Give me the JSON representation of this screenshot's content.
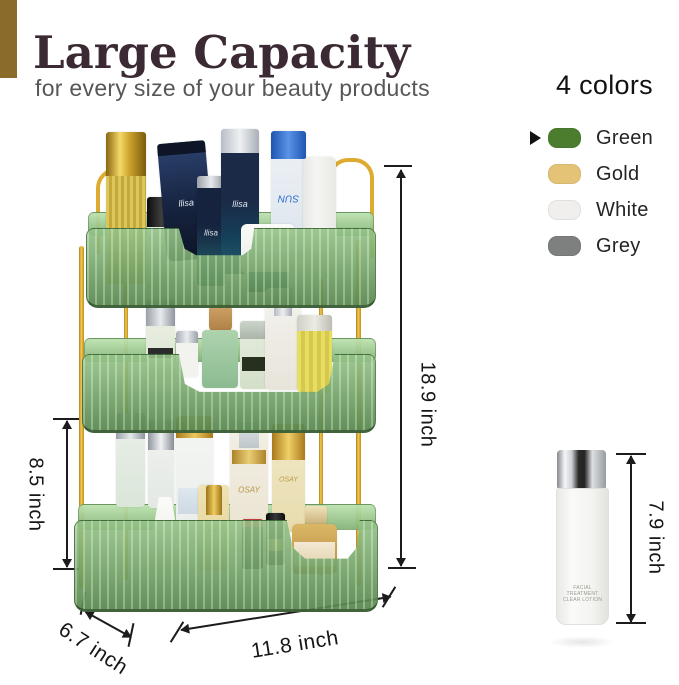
{
  "header": {
    "title": "Large Capacity",
    "subtitle": "for every size of your beauty products",
    "accent_bar_color": "#8a6b2b",
    "title_color": "#3b2a33"
  },
  "colors_panel": {
    "heading": "4 colors",
    "selected_index": 0,
    "items": [
      {
        "label": "Green",
        "swatch": "#4c7d2f"
      },
      {
        "label": "Gold",
        "swatch": "#e4c377"
      },
      {
        "label": "White",
        "swatch": "#f0efed"
      },
      {
        "label": "Grey",
        "swatch": "#7e8080"
      }
    ]
  },
  "dimensions": {
    "total_height": "18.9 inch",
    "tier_height": "8.5 inch",
    "bottle_height": "7.9 inch",
    "depth": "6.7 inch",
    "width": "11.8 inch"
  },
  "bottle": {
    "label_line1": "FACIAL TREATMENT",
    "label_line2": "CLEAR LOTION"
  },
  "organizer": {
    "frame_color": "#dcab2f",
    "tray_color": "#6fa263",
    "products": [
      {
        "name": "gold-cap-bottle",
        "l": 106,
        "t": 132,
        "w": 40,
        "h": 152,
        "r": "5px",
        "cap": {
          "h": 44,
          "c": "linear-gradient(90deg,#8a6510,#f3d967 35%,#caa02c 60%,#7c5a0e)"
        },
        "body": "repeating-linear-gradient(90deg,#dcc65c 0 3px,#c4a83a 3px 6px)"
      },
      {
        "name": "black-cap-bottle",
        "l": 147,
        "t": 197,
        "w": 29,
        "h": 92,
        "r": "4px",
        "cap": {
          "h": 30,
          "c": "linear-gradient(90deg,#0c0c0c,#3f3f3f,#111)"
        },
        "body": "linear-gradient(180deg,#e8efe9,#cfe0da)"
      },
      {
        "name": "navy-tube",
        "l": 162,
        "t": 142,
        "w": 48,
        "h": 118,
        "r": "8px",
        "rot": -5,
        "cap": {
          "h": 12,
          "c": "#0d1526"
        },
        "body": "linear-gradient(180deg,#2c4370,#16233f 55%,#0d1526)",
        "label": "llisa",
        "lc": "#e8ecf2",
        "fs": 9
      },
      {
        "name": "dark-serum-bottle",
        "l": 197,
        "t": 176,
        "w": 28,
        "h": 110,
        "r": "4px",
        "cap": {
          "h": 12,
          "c": "linear-gradient(90deg,#9aa0a8,#e6e9ec,#8f959d)"
        },
        "body": "linear-gradient(180deg,#16233f 45%,#1d4a5a 75%,#2e6b74)",
        "label": "llisa",
        "lc": "#dfe5ec",
        "fs": 8
      },
      {
        "name": "dark-pump-bottle",
        "l": 221,
        "t": 129,
        "w": 38,
        "h": 145,
        "r": "5px",
        "cap": {
          "h": 24,
          "c": "linear-gradient(90deg,#b9bec6,#eef0f3,#a9aeb6)"
        },
        "body": "linear-gradient(180deg,#1a2a47 50%,#15405a 75%,#27606e)",
        "label": "llisa",
        "lc": "#dfe5ec",
        "fs": 9
      },
      {
        "name": "sun-spray-can",
        "l": 271,
        "t": 131,
        "w": 35,
        "h": 128,
        "r": "6px",
        "cap": {
          "h": 28,
          "c": "linear-gradient(90deg,#1d55b0,#5b93e8,#1d55b0)"
        },
        "body": "linear-gradient(180deg,#eef2f6,#dbe4ec)",
        "label": "SUN",
        "lc": "#2f6fd0",
        "fs": 10,
        "flip": true
      },
      {
        "name": "white-mist-bottle",
        "l": 303,
        "t": 157,
        "w": 33,
        "h": 122,
        "r": "6px",
        "body": "linear-gradient(90deg,#e6e6e2,#f5f5f3 40%,#e8e8e4)"
      },
      {
        "name": "cream-jar",
        "l": 241,
        "t": 224,
        "w": 54,
        "h": 50,
        "r": "6px",
        "body": "linear-gradient(180deg,#fbfbf9,#e8e8e4)"
      },
      {
        "name": "jar-base",
        "l": 247,
        "t": 272,
        "w": 42,
        "h": 20,
        "r": "3px",
        "body": "linear-gradient(180deg,#2e6a78,#1d4c58)"
      },
      {
        "name": "cologne-bottle",
        "l": 146,
        "t": 300,
        "w": 29,
        "h": 78,
        "r": "3px",
        "cap": {
          "h": 26,
          "c": "linear-gradient(90deg,#9aa0a8,#e8ebee,#8f959d)"
        },
        "body": "linear-gradient(180deg,#edf0e6,#dce5d2)",
        "band": {
          "t": 48,
          "h": 10,
          "c": "#2b2b2b"
        }
      },
      {
        "name": "mini-bottle",
        "l": 176,
        "t": 331,
        "w": 22,
        "h": 46,
        "r": "3px",
        "cap": {
          "h": 12,
          "c": "linear-gradient(90deg,#a7adb5,#e9ecef,#9aa1a9)"
        },
        "body": "#f2f2ef"
      },
      {
        "name": "cork-cap",
        "l": 209,
        "t": 304,
        "w": 23,
        "h": 28,
        "r": "6px",
        "body": "linear-gradient(180deg,#cfa368,#b08044)"
      },
      {
        "name": "cork-bottle",
        "l": 202,
        "t": 330,
        "w": 36,
        "h": 58,
        "r": "4px",
        "body": "linear-gradient(180deg,#aed3ae,#8cbb90)"
      },
      {
        "name": "green-perfume",
        "l": 240,
        "t": 321,
        "w": 28,
        "h": 68,
        "r": "4px",
        "cap": {
          "h": 18,
          "c": "linear-gradient(180deg,#cdd5cb,#aab4a8)"
        },
        "body": "linear-gradient(180deg,#e6edde,#d3dfc9)",
        "band": {
          "t": 36,
          "h": 14,
          "c": "#26301f"
        }
      },
      {
        "name": "lotion-pump-bottle",
        "l": 265,
        "t": 288,
        "w": 36,
        "h": 102,
        "r": "5px",
        "cap": {
          "h": 28,
          "w": 18,
          "c": "linear-gradient(90deg,#b5bac2,#eceef1,#a6abb3)"
        },
        "body": "linear-gradient(180deg,#f4f3ee,#e7e4da)"
      },
      {
        "name": "amber-perfume",
        "l": 297,
        "t": 315,
        "w": 35,
        "h": 78,
        "r": "6px",
        "cap": {
          "h": 16,
          "c": "linear-gradient(90deg,#cfcfc6,#ecece4,#bdbdb4)"
        },
        "body": "repeating-linear-gradient(90deg,#e7dd62 0 4px,#d6c84c 4px 8px)"
      },
      {
        "name": "frosted-bottle-1",
        "l": 116,
        "t": 413,
        "w": 29,
        "h": 94,
        "r": "4px",
        "cap": {
          "h": 26,
          "c": "linear-gradient(90deg,#9aa0a8,#e6e9ec,#8f959d)"
        },
        "body": "linear-gradient(180deg,#eaf0e8,#dbe6da)"
      },
      {
        "name": "frosted-bottle-2",
        "l": 148,
        "t": 420,
        "w": 26,
        "h": 88,
        "r": "4px",
        "cap": {
          "h": 30,
          "c": "linear-gradient(90deg,#8f959d,#f0f2f4,#878d95)"
        },
        "body": "linear-gradient(180deg,#f1f3f0,#e3e8e3)"
      },
      {
        "name": "toner-bottle",
        "l": 176,
        "t": 416,
        "w": 37,
        "h": 130,
        "r": "5px",
        "cap": {
          "h": 22,
          "c": "linear-gradient(90deg,#a8791b,#ecc95e,#a8791b)"
        },
        "body": "linear-gradient(180deg,#f4f6f3,#e9ede9)",
        "band": {
          "t": 72,
          "h": 26,
          "c": "linear-gradient(180deg,#dfe7ee,#cdd9e4)"
        }
      },
      {
        "name": "cone-deodorant",
        "l": 146,
        "t": 497,
        "w": 38,
        "h": 74,
        "r": "4px",
        "body": "linear-gradient(180deg,#fbfbf9,#e9e9e5)",
        "clip": "polygon(34% 0,66% 0,100% 100%,0 100%)"
      },
      {
        "name": "gold-serum-pump",
        "l": 198,
        "t": 485,
        "w": 31,
        "h": 86,
        "r": "4px",
        "cap": {
          "h": 30,
          "w": 16,
          "c": "linear-gradient(90deg,#9c7216,#eecb60,#9c7216)"
        },
        "body": "linear-gradient(180deg,#efe2b4,#e3cf92)",
        "label": "OSAY",
        "lc": "#b08a30",
        "fs": 7
      },
      {
        "name": "osay-pump-bottle",
        "l": 230,
        "t": 422,
        "w": 38,
        "h": 130,
        "r": "5px",
        "cap": {
          "h": 26,
          "w": 20,
          "c": "linear-gradient(180deg,rgba(222,228,232,.95),rgba(188,196,202,.95))"
        },
        "body": "linear-gradient(180deg,#f2efe4,#eae2cf)",
        "band": {
          "t": 28,
          "h": 14,
          "c": "linear-gradient(90deg,#ad832a,#e9cd74,#ad832a)"
        },
        "label": "OSAY",
        "lc": "#b59545",
        "fs": 8
      },
      {
        "name": "osay-tall-bottle",
        "l": 272,
        "t": 424,
        "w": 33,
        "h": 108,
        "r": "5px",
        "cap": {
          "h": 36,
          "c": "linear-gradient(90deg,#a8791b,#f0d068,#a8791b)"
        },
        "body": "linear-gradient(180deg,#f0e8c6,#e8dcae)",
        "label": "OSAY",
        "lc": "#bb9b4b",
        "fs": 7
      },
      {
        "name": "black-lipstick",
        "l": 242,
        "t": 519,
        "w": 21,
        "h": 50,
        "r": "3px",
        "cap": {
          "h": 8,
          "c": "#c23b3b"
        },
        "body": "linear-gradient(90deg,#050505,#3c3c3c,#0a0a0a)"
      },
      {
        "name": "gold-band-lipstick",
        "l": 266,
        "t": 513,
        "w": 19,
        "h": 52,
        "r": "3px",
        "cap": {
          "h": 14,
          "c": "linear-gradient(90deg,#0a0a0a,#383838,#0a0a0a)"
        },
        "body": "linear-gradient(90deg,#111,#2e2e2e,#111)",
        "band": {
          "t": 26,
          "h": 12,
          "c": "linear-gradient(90deg,#8a6716,#e2c368,#8a6716)"
        }
      },
      {
        "name": "gold-perfume-cap",
        "l": 305,
        "t": 506,
        "w": 22,
        "h": 18,
        "r": "3px",
        "body": "linear-gradient(180deg,#efe2bc,#cbb27a)"
      },
      {
        "name": "gold-perfume",
        "l": 292,
        "t": 524,
        "w": 45,
        "h": 50,
        "r": "5px",
        "body": "linear-gradient(180deg,#dab766,#b88c3e)",
        "band": {
          "t": 18,
          "h": 24,
          "c": "linear-gradient(180deg,#f2e9d4,#e3d3ac)"
        }
      }
    ]
  }
}
